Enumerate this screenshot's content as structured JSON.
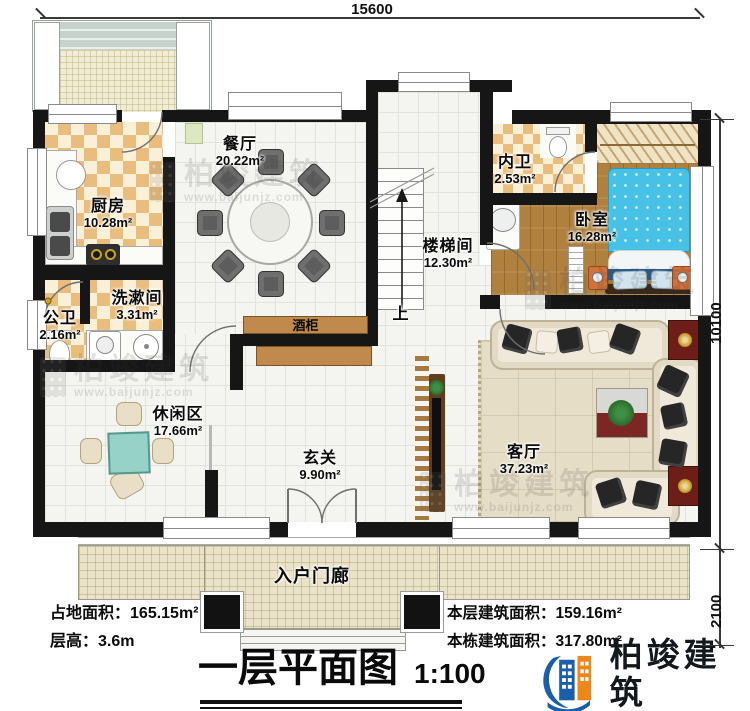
{
  "dimensions": {
    "top": "15600",
    "side_main": "10100",
    "side_porch": "2100"
  },
  "rooms": {
    "kitchen": {
      "name": "厨房",
      "area": "10.28m²"
    },
    "dining": {
      "name": "餐厅",
      "area": "20.22m²"
    },
    "stairwell": {
      "name": "楼梯间",
      "area": "12.30m²"
    },
    "inner_bath": {
      "name": "内卫",
      "area": "2.53m²"
    },
    "bedroom": {
      "name": "卧室",
      "area": "16.28m²"
    },
    "washroom": {
      "name": "洗漱间",
      "area": "3.31m²"
    },
    "public_bath": {
      "name": "公卫",
      "area": "2.16m²"
    },
    "leisure": {
      "name": "休闲区",
      "area": "17.66m²"
    },
    "foyer": {
      "name": "玄关",
      "area": "9.90m²"
    },
    "living": {
      "name": "客厅",
      "area": "37.23m²"
    },
    "porch": {
      "name": "入户门廊"
    }
  },
  "labels": {
    "wine_cabinet": "酒柜",
    "stairs_up": "上"
  },
  "stats": {
    "land_area_label": "占地面积：",
    "land_area_value": "165.15m²",
    "floor_height_label": "层高：",
    "floor_height_value": "3.6m",
    "floor_area_label": "本层建筑面积：",
    "floor_area_value": "159.16m²",
    "building_area_label": "本栋建筑面积：",
    "building_area_value": "317.80m²"
  },
  "title_block": {
    "title": "一层平面图",
    "scale": "1:100"
  },
  "brand": {
    "name": "柏竣建筑",
    "url": "www.baijunjz.com"
  },
  "watermark": {
    "name": "柏竣建筑",
    "url": "www.baijunjz.com"
  },
  "colors": {
    "wall": "#161616",
    "accent_blue": "#1b5ea9",
    "accent_orange": "#f08519",
    "bed_blue": "#47c1e5"
  }
}
